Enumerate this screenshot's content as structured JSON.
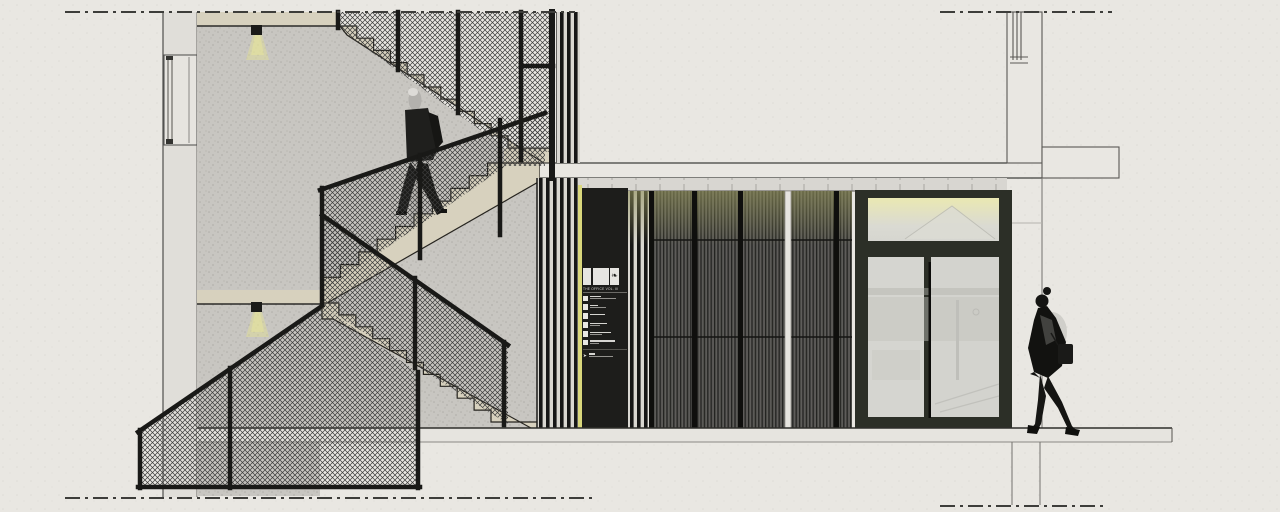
{
  "sign": {
    "title": "THE OFFICE VOL. III",
    "logo_glyph": "❧",
    "logo_blocks": 3,
    "entry_line_widths": [
      [
        11,
        26
      ],
      [
        8,
        16
      ],
      [
        15,
        0
      ],
      [
        17,
        10
      ],
      [
        21,
        12
      ],
      [
        25,
        9
      ]
    ],
    "footer_line_widths": [
      [
        6,
        24
      ]
    ],
    "footer_icon": "➤"
  },
  "colors": {
    "paper": "#e9e7e2",
    "concrete": "#c8c6c1",
    "tread_beige": "#d7d1be",
    "railing_frame": "#191919",
    "mesh_line": "#3a3a3a",
    "accent_yellow": "#d9d77c",
    "signage_bg": "#1d1d1b",
    "panel_dark": "#53524f",
    "panel_tint_olive": "#8e8e52",
    "door_frame": "#2c2f27",
    "glass": "#d5d5d0",
    "transom_tint": "#e9e7b4",
    "section_line": "#3c3c3c"
  }
}
